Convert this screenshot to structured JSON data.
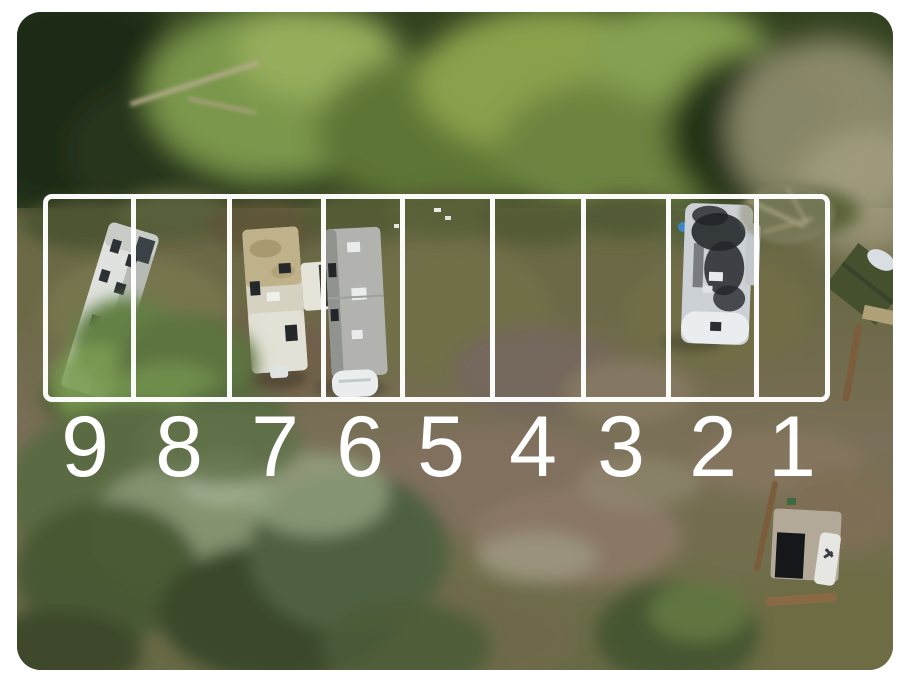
{
  "image": {
    "kind": "aerial-drone-photo-of-rv-lots",
    "frame_color": "#ffffff",
    "overlay": {
      "line_color": "#ffffff",
      "number_color": "#ffffff"
    },
    "lots": [
      {
        "label": "9",
        "occupied": true,
        "vehicle": "white-travel-trailer"
      },
      {
        "label": "8",
        "occupied": false,
        "vehicle": null
      },
      {
        "label": "7",
        "occupied": true,
        "vehicle": "travel-trailer-with-slideout"
      },
      {
        "label": "6",
        "occupied": true,
        "vehicle": "gray-travel-trailer"
      },
      {
        "label": "5",
        "occupied": false,
        "vehicle": null
      },
      {
        "label": "4",
        "occupied": false,
        "vehicle": null
      },
      {
        "label": "3",
        "occupied": false,
        "vehicle": null
      },
      {
        "label": "2",
        "occupied": true,
        "vehicle": "fifth-wheel-rv-weathered-roof"
      },
      {
        "label": "1",
        "occupied": false,
        "vehicle": null
      }
    ]
  }
}
